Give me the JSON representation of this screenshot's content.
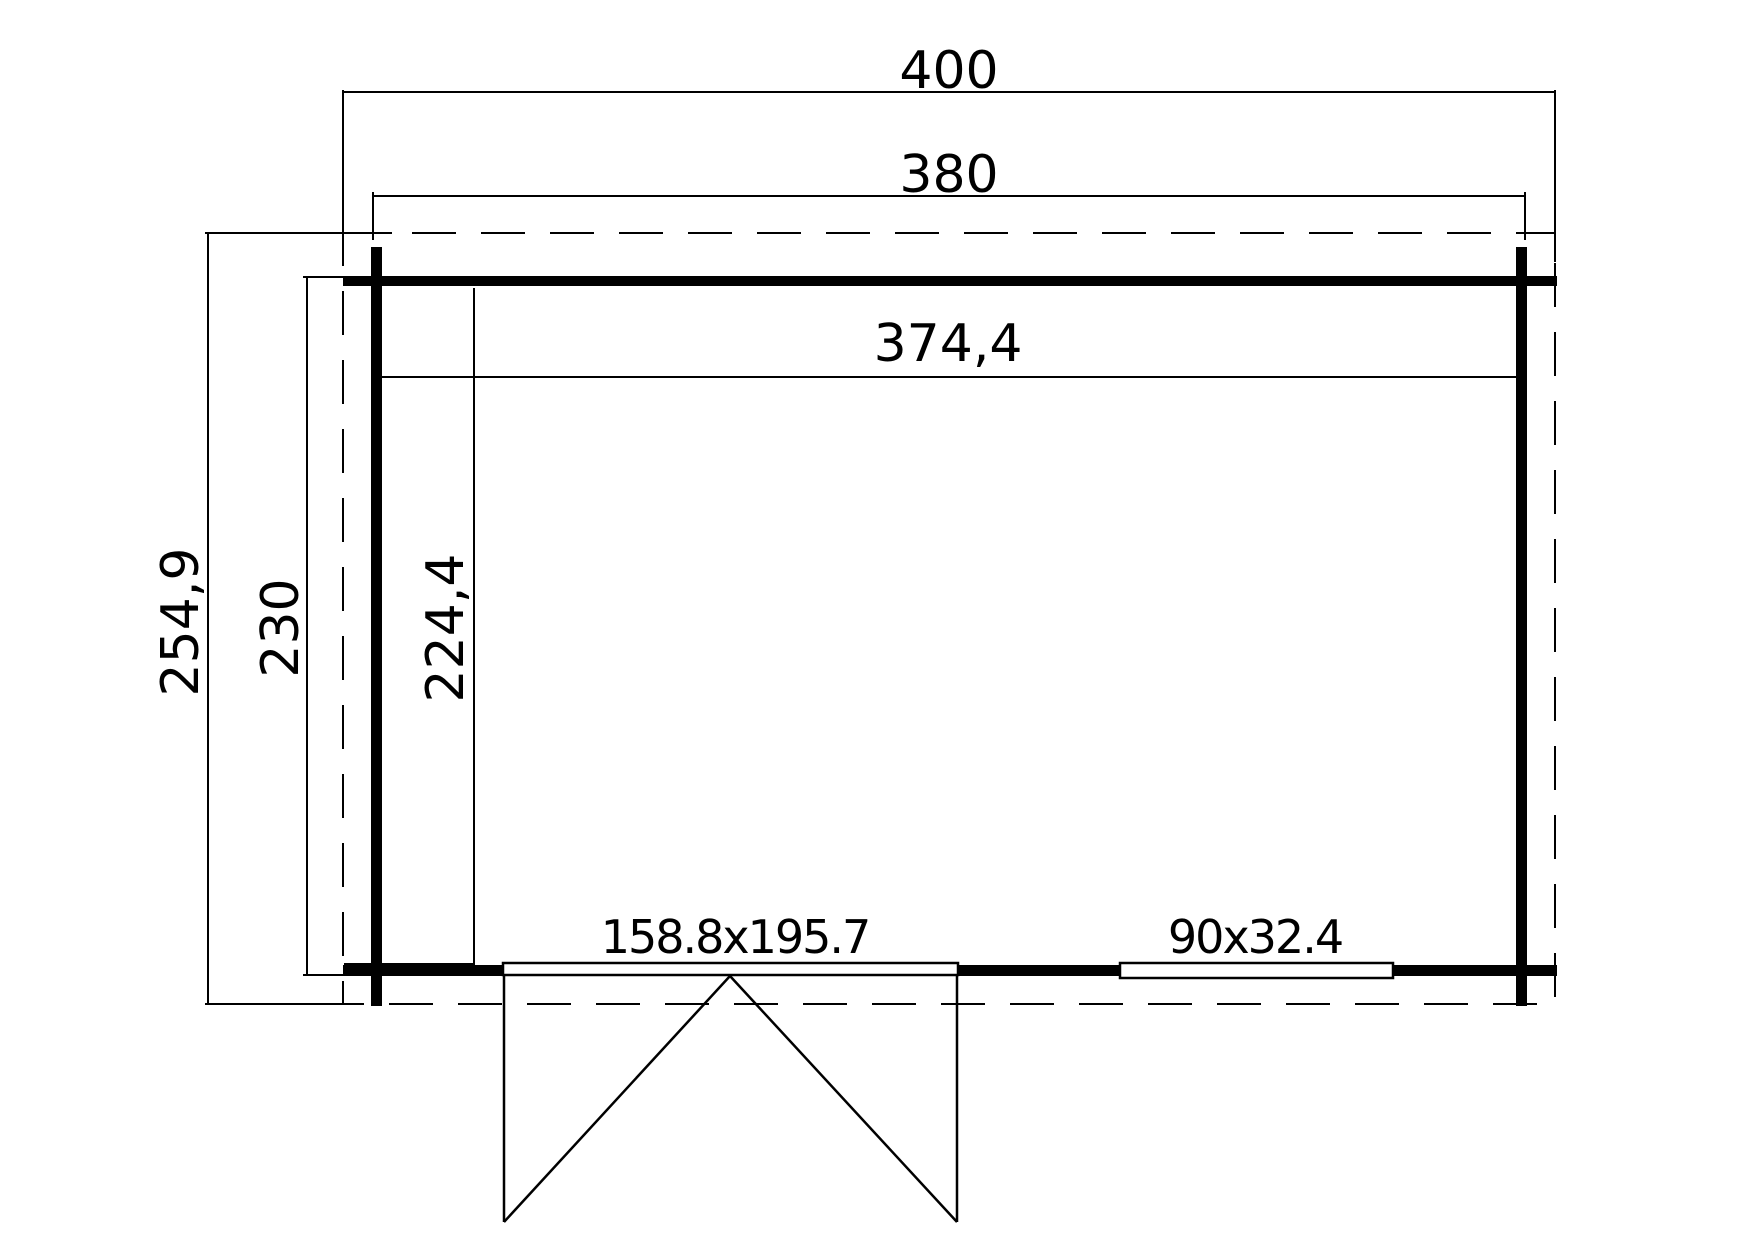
{
  "drawing": {
    "kind": "floor-plan",
    "colors": {
      "line": "#000000",
      "background": "#ffffff"
    },
    "dimensions": {
      "roof_width": "400",
      "base_width": "380",
      "interior_width": "374,4",
      "roof_depth": "254,9",
      "base_depth": "230",
      "interior_depth": "224,4"
    },
    "openings": {
      "double_door": "158.8x195.7",
      "window": "90x32.4"
    }
  }
}
